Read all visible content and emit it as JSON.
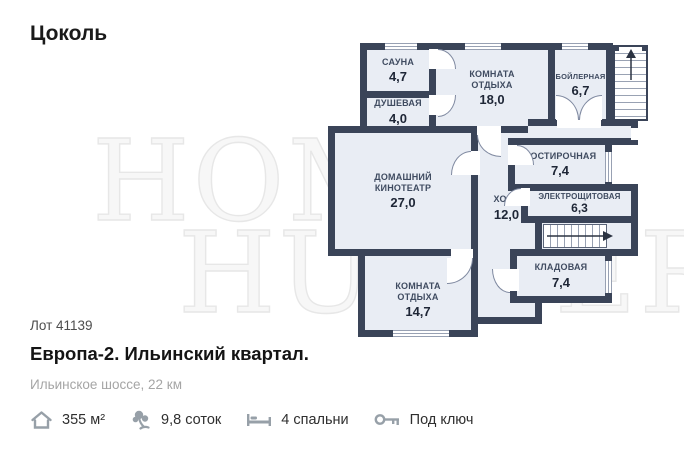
{
  "page": {
    "floor_title": "Цоколь"
  },
  "watermark": {
    "line1": "HOME",
    "line2": "HUNTER"
  },
  "plan": {
    "rooms": [
      {
        "id": "sauna",
        "name": "САУНА",
        "area": "4,7"
      },
      {
        "id": "shower",
        "name": "ДУШЕВАЯ",
        "area": "4,0"
      },
      {
        "id": "lounge-top",
        "name": "КОМНАТА ОТДЫХА",
        "area": "18,0"
      },
      {
        "id": "boiler",
        "name": "БОЙЛЕРНАЯ",
        "area": "6,7"
      },
      {
        "id": "home-theater",
        "name": "ДОМАШНИЙ КИНОТЕАТР",
        "area": "27,0"
      },
      {
        "id": "laundry",
        "name": "ПОСТИРОЧНАЯ",
        "area": "7,4"
      },
      {
        "id": "hall",
        "name": "ХОЛЛ",
        "area": "12,0"
      },
      {
        "id": "electrical",
        "name": "ЭЛЕКТРОЩИТОВАЯ",
        "area": "6,3"
      },
      {
        "id": "storage",
        "name": "КЛАДОВАЯ",
        "area": "7,4"
      },
      {
        "id": "lounge-bottom",
        "name": "КОМНАТА ОТДЫХА",
        "area": "14,7"
      }
    ]
  },
  "listing": {
    "lot": "Лот 41139",
    "title": "Европа-2. Ильинский квартал.",
    "subtitle": "Ильинское шоссе, 22 км",
    "features": [
      {
        "icon": "house-icon",
        "text": "355 м²"
      },
      {
        "icon": "land-icon",
        "text": "9,8 соток"
      },
      {
        "icon": "bed-icon",
        "text": "4 спальни"
      },
      {
        "icon": "key-icon",
        "text": "Под ключ"
      }
    ]
  },
  "colors": {
    "wall": "#3a4458",
    "room_fill": "#e9edf4",
    "label": "#3f4b60"
  }
}
